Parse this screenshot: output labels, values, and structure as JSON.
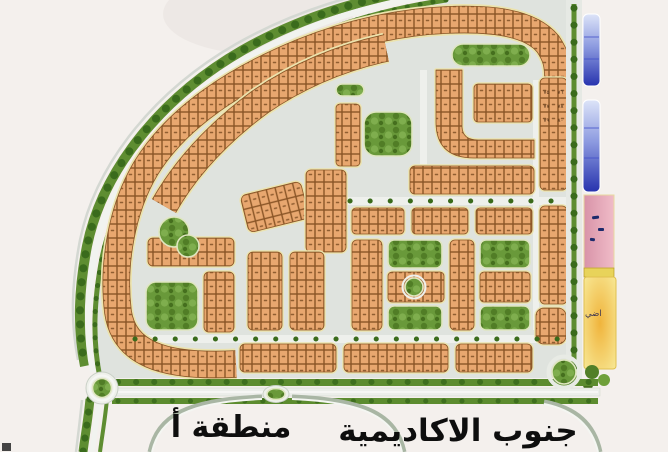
{
  "map": {
    "type": "master-plan",
    "labels": {
      "district": "جنوب الاكاديمية",
      "area": "منطقة أ",
      "yellow_zone_fragment": "اضي"
    },
    "sample_plot_numbers": [
      "٧٥",
      "٧٦",
      "٧٧",
      "٧٨",
      "٧٩",
      "٨٠"
    ],
    "colors": {
      "background": "#F4F0ED",
      "road": "#DFE3DE",
      "plot_fill": "#E8A76F",
      "plot_border": "#8A5526",
      "block_outline": "#ECE3AD",
      "park_green": "#69993A",
      "tree_dark": "#3A6B1C",
      "blue_strip_light": "#DDE4F8",
      "blue_strip_dark": "#2733AE",
      "pink_zone": "#E2A0B4",
      "yellow_zone": "#F2C94E",
      "label_text": "#0E0E0E"
    },
    "zones": [
      {
        "name": "residential-plots",
        "color": "#E8A76F"
      },
      {
        "name": "parks",
        "color": "#69993A"
      },
      {
        "name": "blue-strips",
        "color": "#2733AE"
      },
      {
        "name": "pink-strip",
        "color": "#E2A0B4"
      },
      {
        "name": "yellow-strip",
        "color": "#F2C94E"
      }
    ]
  }
}
